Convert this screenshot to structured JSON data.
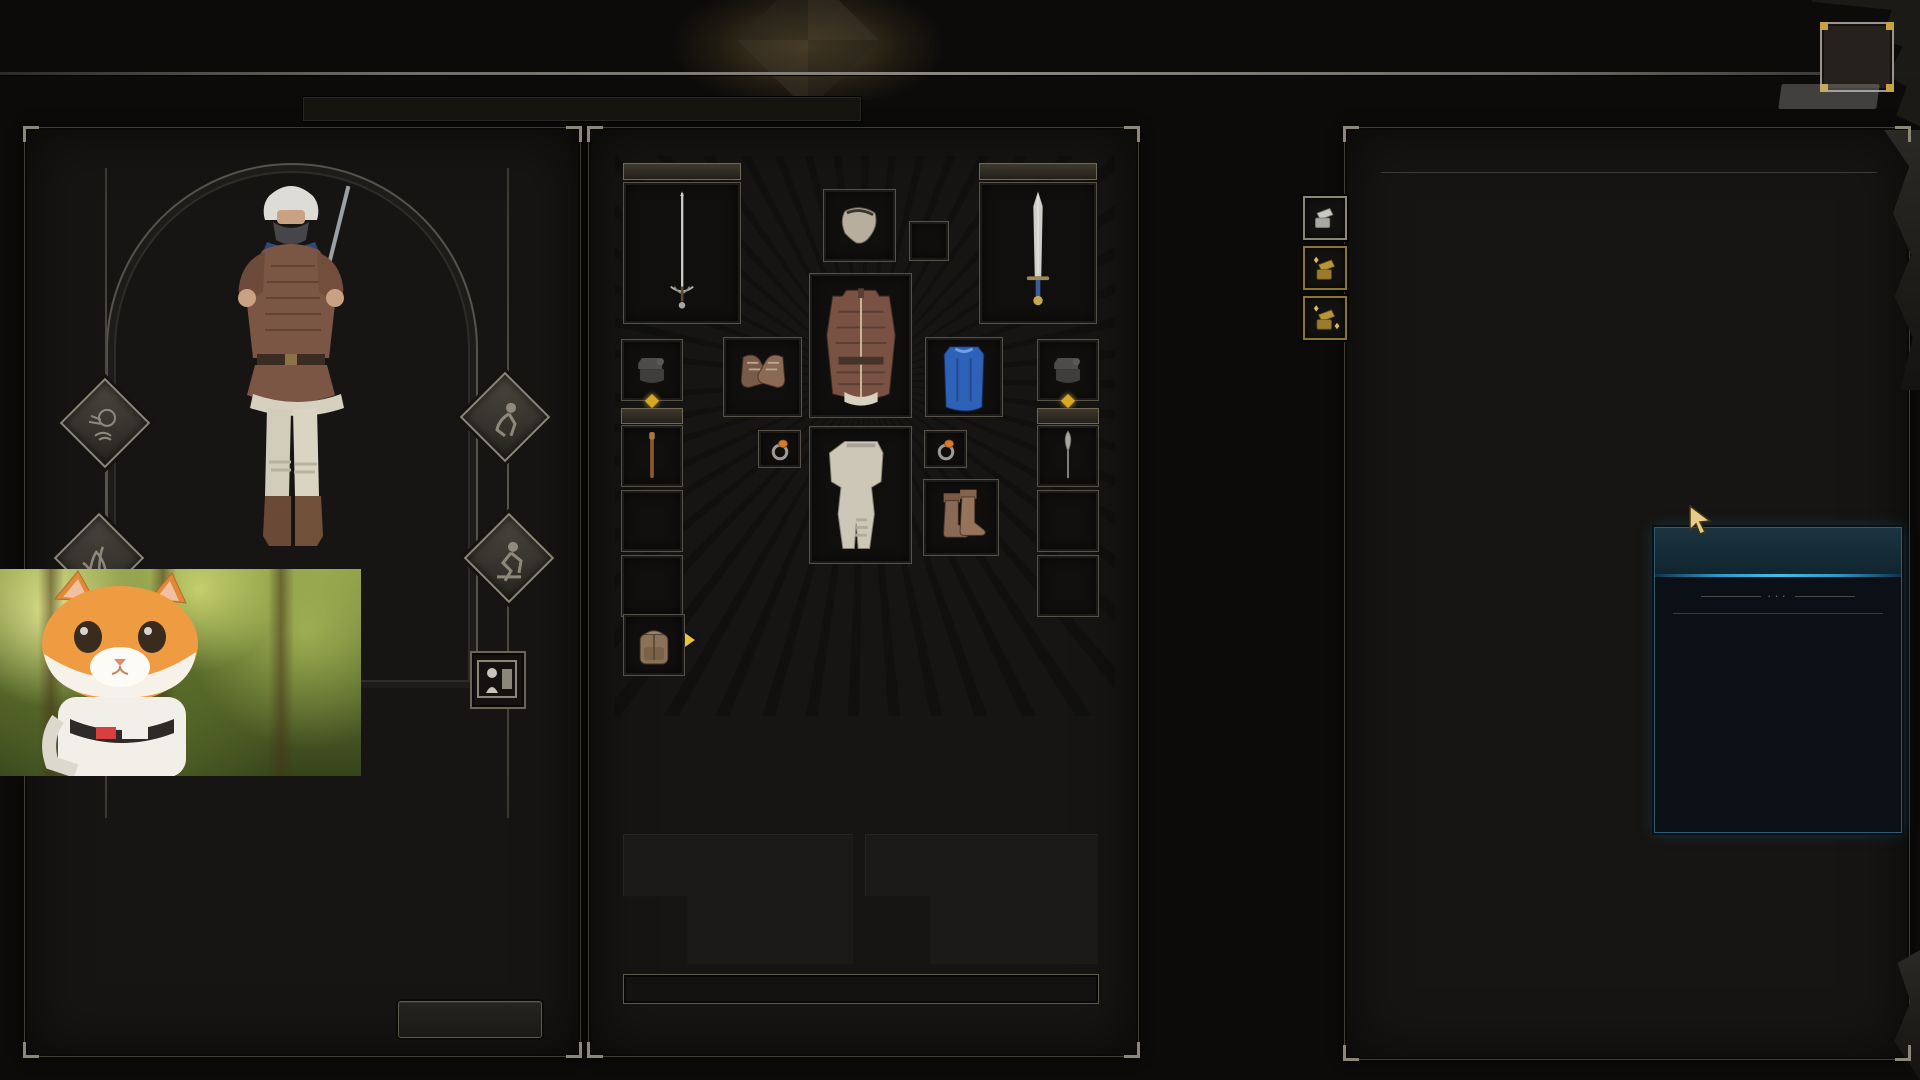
{
  "overlay": {
    "fps": "94",
    "brand_dou": "斗",
    "brand_yu": "鱼",
    "room_label": "房间号",
    "room_number": "11222"
  },
  "nav": {
    "active_index": 3,
    "items": [
      {
        "label": "开始游戏"
      },
      {
        "label": "豪客排行榜"
      },
      {
        "label": "职业"
      },
      {
        "label": "仓库"
      },
      {
        "label": "商人"
      },
      {
        "label": "交易"
      },
      {
        "label": "聚会大厅"
      },
      {
        "label": "定制"
      },
      {
        "label": "商店"
      }
    ]
  },
  "hint_bar": "[Alt + L 拖动] 拆分物品 , [Alt + R 单击] 逐一发送 , [Shift + R 单击] 一次发送全部",
  "character": {
    "stats": [
      {
        "label": "",
        "value": "22"
      },
      {
        "label": "活力",
        "value": "8"
      },
      {
        "label": "敏捷",
        "value": "32"
      },
      {
        "label": "灵巧",
        "value": "36"
      },
      {
        "label": "意志",
        "value": "12"
      },
      {
        "label": "知识",
        "value": "13"
      },
      {
        "label": "足智多谋",
        "value": "22"
      }
    ],
    "hp_label": "血量",
    "hp_current": "100",
    "hp_sep": "/",
    "hp_max": "100",
    "details_button": "打开详情"
  },
  "equipment": {
    "slot1_label": "1",
    "slot2_label": "2",
    "slot3_label": "3",
    "slot4_label": "4",
    "slot3_count": "2",
    "slot4_count": "2",
    "gold_label": "金币 :",
    "gold_value": "3,512"
  },
  "warehouse": {
    "title": "仓库",
    "side_buttons": [
      {
        "icon": "chest-open-silver"
      },
      {
        "icon": "chest-open-gold"
      },
      {
        "icon": "chest-open-gold-sparkles"
      }
    ],
    "grid": {
      "cols": 12,
      "rows": [
        [
          "sack:50",
          "sack:50",
          "sack:50",
          "sack:50",
          "sack:50",
          "sack:50",
          "sack:50",
          "sack:50",
          "sack:50",
          "sack:50",
          "sack:50",
          "sack:50"
        ],
        [
          "sack:50",
          "sack:50",
          "sack:50",
          "sack:50",
          "sack:50",
          "sack:50",
          "sack:50",
          "sack:50",
          "sack:50",
          "sack:50",
          "sack:50",
          "sack:50"
        ],
        [
          "sack:50",
          "sack:50",
          "sack:50",
          "sack:50",
          "sack:50",
          "sack:50",
          "sack:50",
          "sack:50",
          "sack:50",
          "sack:50",
          "sack:50",
          "sack:50"
        ],
        [
          "sack:50",
          "sack:50",
          "sack:50",
          "sack:50",
          "sack:50",
          "sack:50",
          "sack:50",
          "sack:50",
          "sack:50",
          "sack:50",
          "sack:50",
          "sack:50"
        ],
        [
          "sack:50",
          "sack:50",
          "sack:50",
          "sack:50",
          "sack:50",
          "sack:50",
          "sack:50",
          "sack:50",
          "sack:50",
          "sack:50",
          "sack:50",
          "sack:50"
        ],
        [
          "sack:50",
          "sack:50",
          "sack:50",
          "sack:50",
          "sack:46",
          "sack:46",
          "sack:50",
          "sack:50",
          "sack:50",
          "sack:50",
          "sack:20",
          "sack:0"
        ],
        [
          "sack:0",
          "",
          "",
          "",
          "",
          "",
          "",
          "",
          "",
          "",
          "med",
          "med"
        ],
        [
          "",
          "med",
          "ringo",
          "med",
          "med",
          "med",
          "med",
          "med!",
          "torc",
          "med",
          "med",
          "med"
        ],
        [
          "",
          "",
          "",
          "ringb",
          "ringo",
          "",
          "ringb",
          "",
          "",
          "",
          "",
          ""
        ],
        [
          "trip:3",
          "trip:3",
          "trip:3",
          "trip:3",
          "trip:3",
          "trip:3",
          "trip:3",
          "",
          "",
          "",
          "",
          ""
        ],
        [
          "trip:3",
          "trip:3",
          "trip:3",
          "trip:3",
          "trip:3",
          "trip:3",
          "",
          "",
          "",
          "",
          "",
          ""
        ],
        [
          "jav",
          "jav",
          "jav",
          "jav",
          "jav",
          "jav",
          "jav",
          "",
          "",
          "",
          "",
          ""
        ],
        [
          "swd",
          "swd",
          "flam",
          "swd",
          "swd",
          "swd",
          "swd",
          "",
          "",
          "",
          "",
          ""
        ],
        [
          "tswd*3",
          "tswd*3",
          "tswd*3",
          "tswd*3",
          "tswd*3",
          "tswd*3",
          "",
          "",
          "",
          "",
          "",
          ""
        ],
        [
          "^",
          "^",
          "^",
          "^",
          "^",
          "^",
          "",
          "",
          "",
          "",
          "",
          ""
        ],
        [
          "^",
          "^",
          "^",
          "^",
          "^",
          "^",
          "",
          "",
          "",
          "",
          "",
          ""
        ],
        [
          "bag*2",
          "",
          "",
          "",
          "",
          "",
          "",
          "",
          "",
          "",
          "",
          "potb:3"
        ],
        [
          "^",
          "",
          "",
          "",
          "",
          "",
          "",
          "",
          "potr:3",
          "potr:3",
          "potr:3",
          "potr:3"
        ],
        [
          "bag*2",
          "",
          "",
          "",
          "",
          "",
          "",
          "",
          "",
          "",
          "",
          "btl:2*2"
        ],
        [
          "^",
          "",
          "",
          "",
          "",
          "",
          "",
          "",
          "",
          "",
          "",
          "^"
        ]
      ]
    }
  },
  "tooltip": {
    "title": "和平项链",
    "dash": "-",
    "stats": [
      {
        "text": "7 最大血量",
        "color": "white"
      },
      {
        "text": "+9.7% 增益持续时间",
        "color": "cyan"
      },
      {
        "text": "+3 真实物理伤害",
        "color": "cyan"
      }
    ],
    "props": [
      {
        "label": "槽位属性:",
        "value": "项链",
        "value_color": "#cfd0c8"
      },
      {
        "label": "战利品状态:",
        "value": "用过品",
        "value_color": "#8fd8b8"
      },
      {
        "label": "稀有度:",
        "value": "稀有",
        "value_color": "#41bfe8"
      }
    ],
    "footer": "和平项链"
  },
  "colors": {
    "accent_gold": "#c9a855",
    "stat_green": "#b9d94d",
    "accent_cyan": "#41bfe8",
    "cell_teal": "#1d3240",
    "fps_green": "#76c82e"
  }
}
